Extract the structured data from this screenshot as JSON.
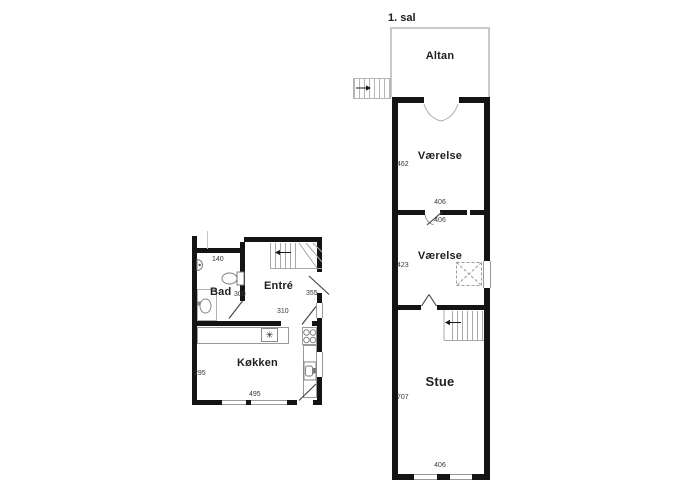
{
  "upper": {
    "title": "1. sal",
    "altan": {
      "label": "Altan"
    },
    "vaerelse1": {
      "label": "Værelse",
      "dim_left": "462",
      "dim_bottom": "406"
    },
    "vaerelse2": {
      "label": "Værelse",
      "dim_top": "406",
      "dim_left": "423"
    },
    "stue": {
      "label": "Stue",
      "dim_left": "707",
      "dim_bottom": "406"
    }
  },
  "ground": {
    "bad": {
      "label": "Bad",
      "dim_top": "140",
      "dim_right": "300"
    },
    "entre": {
      "label": "Entré",
      "dim_right": "355",
      "dim_passage": "310"
    },
    "koekken": {
      "label": "Køkken",
      "dim_left": "295",
      "dim_bottom": "495",
      "appliance_symbol": "✳"
    }
  },
  "colors": {
    "wall": "#141414",
    "fixture_line": "#8f8f8f",
    "balcony_outline": "#c9c9c9"
  }
}
